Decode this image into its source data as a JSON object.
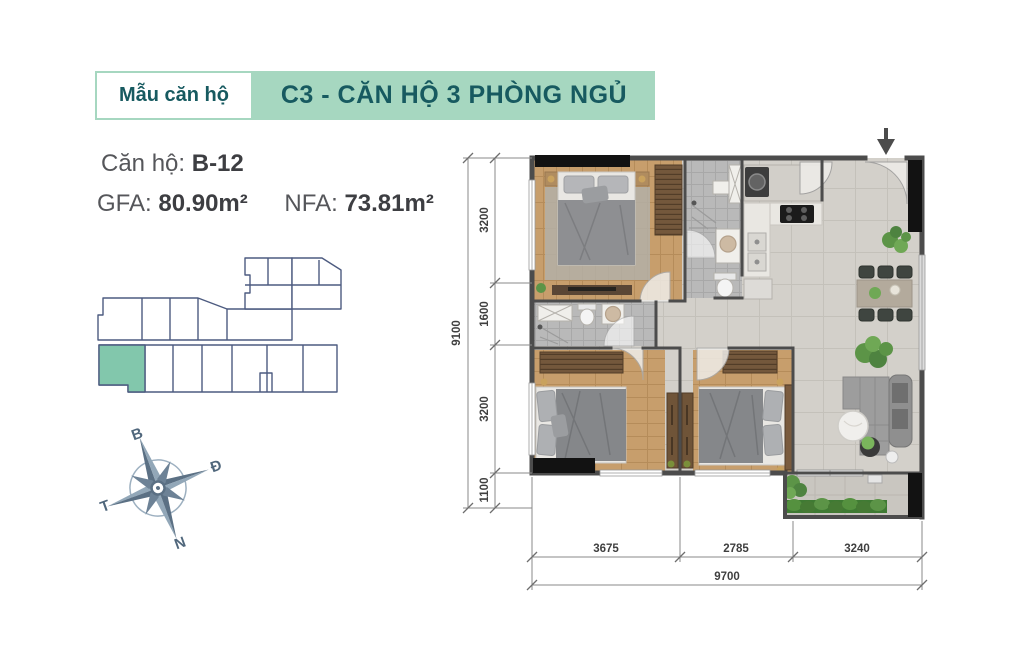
{
  "header": {
    "label": "Mẫu căn hộ",
    "title": "C3 - CĂN HỘ 3 PHÒNG NGỦ"
  },
  "unit_info": {
    "unit_label": "Căn hộ:",
    "unit_value": "B-12",
    "gfa_label": "GFA:",
    "gfa_value": "80.90m²",
    "nfa_label": "NFA:",
    "nfa_value": "73.81m²"
  },
  "compass": {
    "north_label": "B",
    "east_label": "Đ",
    "west_label": "T",
    "south_label": "N"
  },
  "dimensions": {
    "left_segments": [
      "3200",
      "1600",
      "3200",
      "1100"
    ],
    "left_total": "9100",
    "bottom_segments": [
      "3675",
      "2785",
      "3240"
    ],
    "bottom_total": "9700"
  },
  "colors": {
    "header_green": "#a6d7c0",
    "header_text": "#175a60",
    "body_text": "#55565a",
    "navy": "#4d5b80",
    "teal_unit": "#82c7ac",
    "compass_dark": "#5b7084",
    "dim_text": "#3f3f3f",
    "wall": "#4c4c4c",
    "wall_black": "#121212",
    "wood": "#c79e6c",
    "bath_tile": "#b9b9b9",
    "living_tile": "#d3d0ca",
    "plant": "#5c9447"
  }
}
